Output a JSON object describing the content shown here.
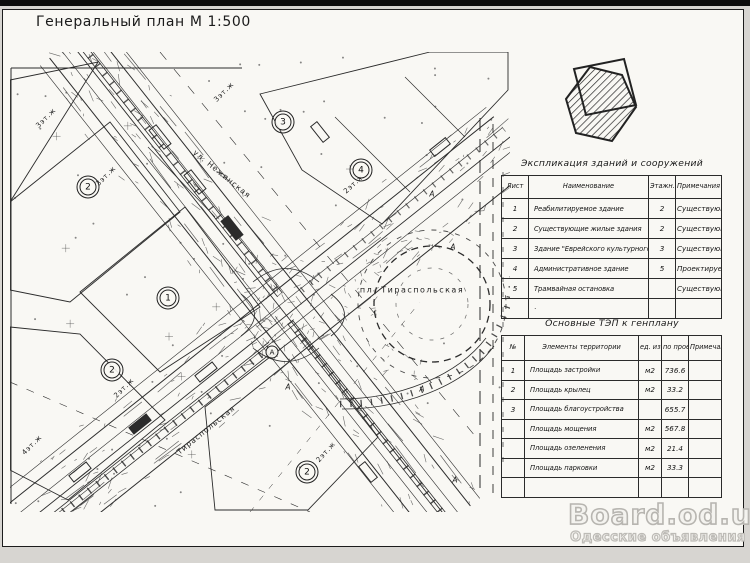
{
  "colors": {
    "ink": "#1f1f1f",
    "paper": "#f9f8f4",
    "watermark": "#b7b5b0"
  },
  "sheet": {
    "title": "Генеральный план М 1:500"
  },
  "map": {
    "street_labels": [
      {
        "t": "ул. Нежинская",
        "x": 212,
        "y": 122,
        "r": 39,
        "cls": "street-label"
      },
      {
        "t": "Тираспольская",
        "x": 196,
        "y": 378,
        "r": -39,
        "cls": "street-label"
      },
      {
        "t": "пл. Тираспольская",
        "x": 402,
        "y": 238,
        "r": 0,
        "cls": "square-label"
      }
    ],
    "storey_labels": [
      {
        "t": "3эт.ж",
        "x": 36,
        "y": 66,
        "r": -45
      },
      {
        "t": "3эт.ж",
        "x": 96,
        "y": 124,
        "r": -45
      },
      {
        "t": "3эт.ж",
        "x": 214,
        "y": 40,
        "r": -45
      },
      {
        "t": "2эт.ж",
        "x": 344,
        "y": 132,
        "r": -42
      },
      {
        "t": "2эт.ж",
        "x": 114,
        "y": 336,
        "r": -45
      },
      {
        "t": "4эт.ж",
        "x": 22,
        "y": 393,
        "r": -45
      },
      {
        "t": "2эт.ж",
        "x": 316,
        "y": 400,
        "r": -48
      }
    ],
    "building_numbers": [
      {
        "n": "2",
        "x": 78,
        "y": 135,
        "double": true
      },
      {
        "n": "3",
        "x": 273,
        "y": 70,
        "double": true
      },
      {
        "n": "4",
        "x": 351,
        "y": 118,
        "double": true
      },
      {
        "n": "1",
        "x": 158,
        "y": 246,
        "double": true
      },
      {
        "n": "2",
        "x": 102,
        "y": 318,
        "double": true
      },
      {
        "n": "2",
        "x": 297,
        "y": 420,
        "double": true
      },
      {
        "n": "А",
        "x": 262,
        "y": 300,
        "double": false,
        "small": true
      }
    ],
    "site_letters": [
      {
        "t": "А",
        "x": 278,
        "y": 335
      },
      {
        "t": "А",
        "x": 412,
        "y": 337
      },
      {
        "t": "А",
        "x": 422,
        "y": 142
      },
      {
        "t": "А",
        "x": 443,
        "y": 195
      },
      {
        "t": "А",
        "x": 445,
        "y": 428
      }
    ]
  },
  "explication": {
    "title": "Экспликация зданий и сооружений",
    "headers": [
      "Лист",
      "Наименование",
      "Этажн.",
      "Примечания"
    ],
    "rows": [
      [
        "1",
        "Реабилитируемое здание",
        "2",
        "Существующие"
      ],
      [
        "2",
        "Существующие жилые  здания",
        "2",
        "Существующие"
      ],
      [
        "3",
        "Здание \"Еврейского культурного центра\"",
        "3",
        "Существующие"
      ],
      [
        "4",
        "Административное здание",
        "5",
        "Проектируемое"
      ],
      [
        "5",
        "Трамвайная  остановка",
        "",
        "Существующая"
      ],
      [
        "",
        "·",
        "",
        ""
      ]
    ]
  },
  "tep": {
    "title": "Основные ТЭП к генплану",
    "headers": [
      "№",
      "Элементы территории",
      "ед. изм",
      "по проекту",
      "Примечания"
    ],
    "rows": [
      [
        "1",
        "Площадь застройки",
        "м2",
        "736.6",
        ""
      ],
      [
        "2",
        "Площадь крылец",
        "м2",
        "33.2",
        ""
      ],
      [
        "3",
        "Площадь благоустройства",
        "",
        "655.7",
        ""
      ],
      [
        "",
        "Площадь мощения",
        "м2",
        "567.8",
        ""
      ],
      [
        "",
        "Площадь озеленения",
        "м2",
        "21.4",
        ""
      ],
      [
        "",
        "Площадь парковки",
        "м2",
        "33.3",
        ""
      ],
      [
        "",
        "",
        "",
        "",
        ""
      ]
    ]
  },
  "watermark": {
    "line1": "Board.od.ua",
    "line2": "Одесские объявления"
  }
}
